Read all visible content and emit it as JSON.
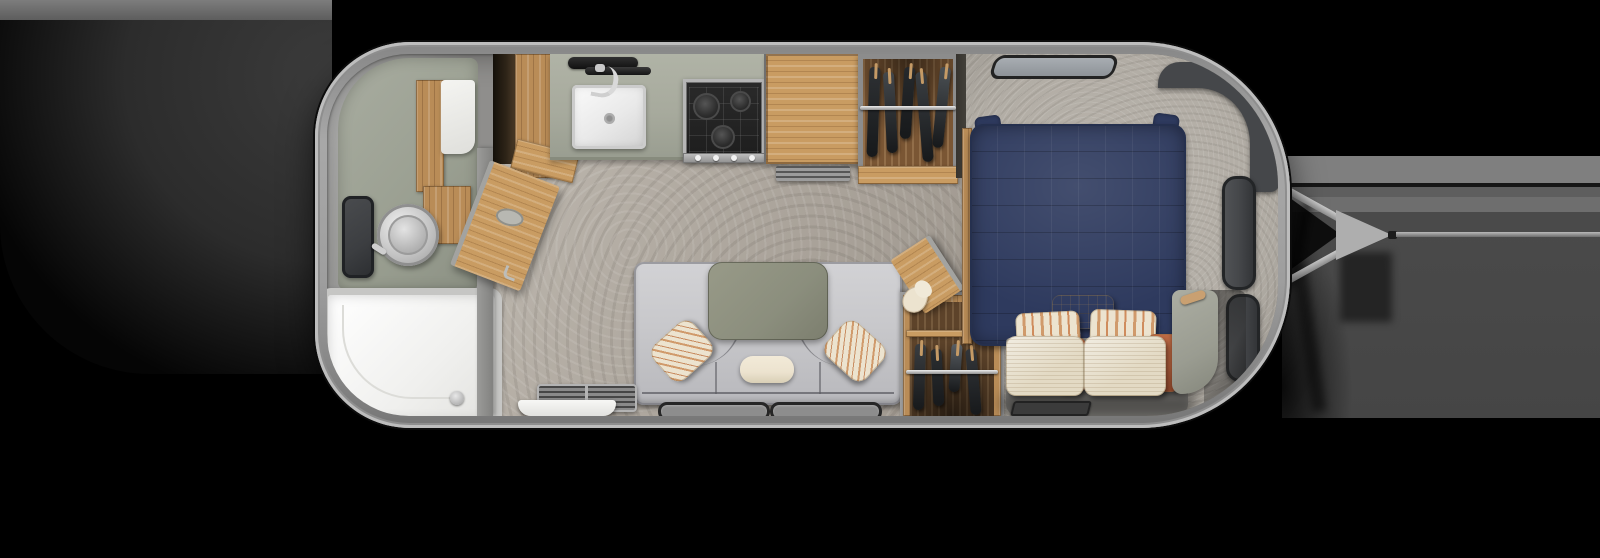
{
  "meta": {
    "title": "Travel trailer floor plan — top-down 3D render",
    "orientation": "rear-left, hitch-right",
    "scene": "dark studio backdrop"
  },
  "palette": {
    "backBand": "#7d7d7d",
    "backBody": "#3b3b3b",
    "backRight": "#4a4a4a",
    "interiorBase": "#8f8e8c",
    "vinyl": "#aba49b",
    "vinylHi": "#bdb7ae",
    "carpet": "#b2ada5",
    "carpetLo": "#8f8b84",
    "sage": "#9ba092",
    "counter": "#a7aa9d",
    "counterEdge": "#878b7d",
    "wood": "#b98c57",
    "woodLight": "#c99c62",
    "mirror": "#3c3e41",
    "stoveTop": "#1d1d1d",
    "stoveFrame": "#b6b6b6",
    "navy": "#2e3a5e",
    "navyDark": "#25304e",
    "sofa": "#c8c8cb",
    "table": "#8b8e7d",
    "cream": "#ece3cf",
    "cream2": "#e3dac4",
    "stripeTan": "#d09a6b",
    "rust": "#b05f3c",
    "locker": "#45474a",
    "lockerEdge": "#232527",
    "platform": "#908e8a",
    "matDark": "#3b3b3b",
    "bedroomWall": "#43403a"
  },
  "labels": {
    "stage": "Travel trailer floor plan, top-down view, hitch pointing right",
    "trailer": "trailer shell",
    "bathroom": "rear bathroom with shower, toilet, vanity and mirror",
    "shower": "shower pan",
    "toilet": "toilet",
    "vanity": "wood vanity",
    "mirror": "bathroom mirror panel",
    "bath_door": "open bathroom door",
    "closet": "rear closet",
    "kitchen": "galley kitchen",
    "sink": "kitchen sink",
    "faucet": "kitchen faucet",
    "cooktop": "three-burner cooktop",
    "refrigerator": "refrigerator with wood panel top",
    "counter": "kitchen countertop",
    "wardrobe_top": "wardrobe with hanging clothes (street side)",
    "wardrobe_bottom": "wardrobe with hanging clothes (curb side)",
    "sofa": "U-shaped lounge sofa",
    "sofa_table": "lounge table",
    "entry": "entry step and mat",
    "windows": "lounge windows",
    "bedroom": "front bedroom",
    "bed": "bed with navy comforter",
    "pillows": "bed pillows",
    "roof_window": "front roof window",
    "lockers": "front overhead lockers",
    "front_cabinet": "front corner cabinet",
    "hitch": "A-frame hitch and tow bar"
  },
  "wardrobes": {
    "top": {
      "garments": [
        "#2e3134",
        "#43474b",
        "#26292c",
        "#3a3e42",
        "#4b5054"
      ]
    },
    "bottom": {
      "garments": [
        "#3a3d40",
        "#2c2f32",
        "#595e63",
        "#33363a"
      ]
    }
  },
  "stove": {
    "burners": 3,
    "knobs": 4
  }
}
